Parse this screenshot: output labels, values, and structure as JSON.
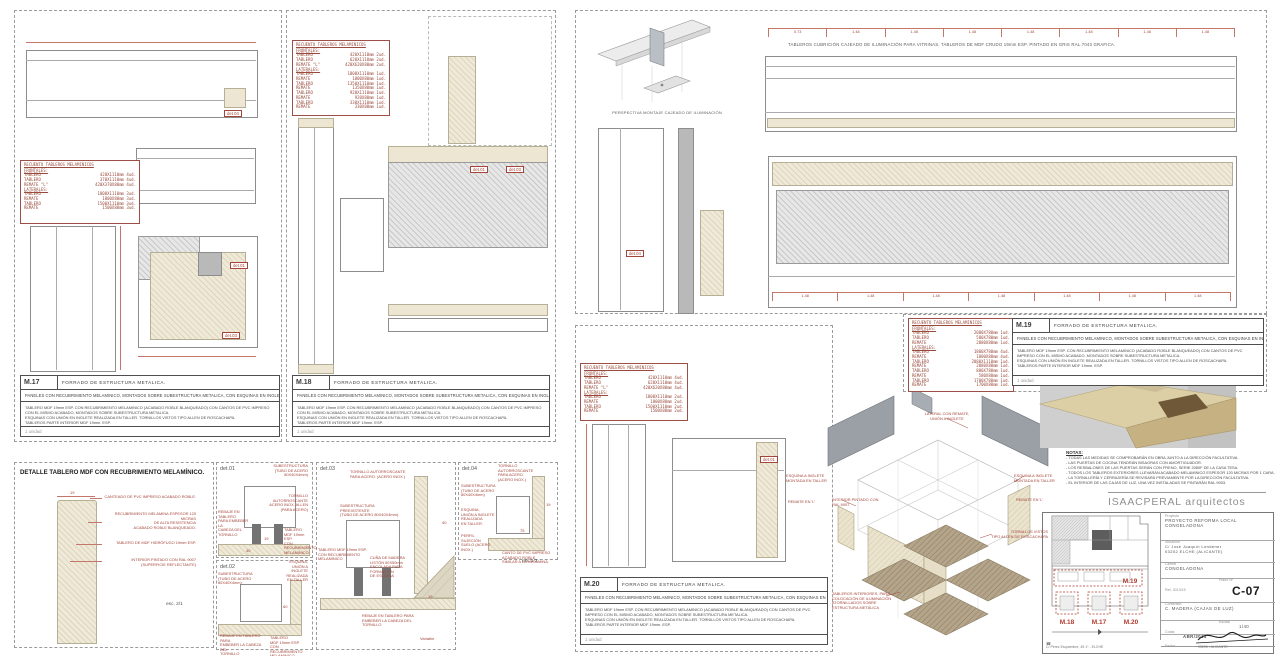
{
  "shared": {
    "recuento_title": "RECUENTO TABLEROS MELAMINICOS",
    "forrado_title": "FORRADO DE ESTRUCTURA METALICA.",
    "paneles_sub": "PANELES CON RECUBRIMIENTO MELAMINICO, MONTADOS SOBRE SUBESTRUCTURA METALICA, CON ESQUINAS EN INGLETE",
    "body_l1": "TABLERO MDF 19mm ESP. CON RECUBRIMIENTO MELAMINICO (ACABADO ROBLE BLANQUEADO) CON CANTOS DE PVC IMPRESO CON EL MISMO ACABADO, MONTADOS SOBRE SUBESTRUCTURA METALICA.",
    "body_l2": "ESQUINAS CON UNIÓN EN INGLETE REALIZADA EN TALLER. TORNILLOS VISTOS TIPO ALLEN DE ROSCACHAPA.",
    "body_l3": "TABLEROS PARTE INTERIOR MDF 19mm. ESP.",
    "units": "1 unidad"
  },
  "m17": {
    "code": "M.17",
    "rows": [
      {
        "a": "FRONTALES:",
        "b": "",
        "h": 1
      },
      {
        "a": "TABLERO",
        "b": "420X1110mm 4ud."
      },
      {
        "a": "TABLERO",
        "b": "370X1110mm 4ud."
      },
      {
        "a": "REMATE \"L\"",
        "b": "420X370X80mm 4ud."
      },
      {
        "a": "LATERALES:",
        "b": "",
        "h": 1
      },
      {
        "a": "TABLERO",
        "b": "1800X1110mm 3ud."
      },
      {
        "a": "REMATE",
        "b": "1800X80mm 3ud."
      },
      {
        "a": "TABLERO",
        "b": "1500X1110mm 3ud."
      },
      {
        "a": "REMATE",
        "b": "1500X80mm 3ud."
      }
    ]
  },
  "m18": {
    "code": "M.18",
    "rows": [
      {
        "a": "FRONTALES:",
        "b": "",
        "h": 1
      },
      {
        "a": "TABLERO",
        "b": "420X1110mm 2ud."
      },
      {
        "a": "TABLERO",
        "b": "620X1110mm 2ud."
      },
      {
        "a": "REMATE \"L\"",
        "b": "420X620X80mm 2ud."
      },
      {
        "a": "LATERALES:",
        "b": "",
        "h": 1
      },
      {
        "a": "TABLERO",
        "b": "1800X1110mm 1ud."
      },
      {
        "a": "REMATE",
        "b": "1800X80mm 1ud."
      },
      {
        "a": "TABLERO",
        "b": "1350X1110mm 1ud."
      },
      {
        "a": "REMATE",
        "b": "1350X80mm 1ud."
      },
      {
        "a": "TABLERO",
        "b": "920X1110mm 1ud."
      },
      {
        "a": "REMATE",
        "b": "920X80mm 1ud."
      },
      {
        "a": "TABLERO",
        "b": "330X1110mm 1ud."
      },
      {
        "a": "REMATE",
        "b": "330X80mm 1ud."
      }
    ]
  },
  "m19": {
    "code": "M.19",
    "rows": [
      {
        "a": "FRONTALES:",
        "b": "",
        "h": 1
      },
      {
        "a": "TABLERO",
        "b": "2080X780mm 1ud."
      },
      {
        "a": "TABLERO",
        "b": "580X780mm 1ud."
      },
      {
        "a": "REMATE",
        "b": "2080X80mm 1ud."
      },
      {
        "a": "LATERALES:",
        "b": "",
        "h": 1
      },
      {
        "a": "TABLERO",
        "b": "1800X780mm 4ud."
      },
      {
        "a": "REMATE",
        "b": "1800X80mm 4ud."
      },
      {
        "a": "TABLERO",
        "b": "2080X1110mm 1ud."
      },
      {
        "a": "REMATE",
        "b": "2080X80mm 1ud."
      },
      {
        "a": "TABLERO",
        "b": "800X780mm 1ud."
      },
      {
        "a": "REMATE",
        "b": "580X80mm 1ud."
      },
      {
        "a": "TABLERO",
        "b": "1700X780mm 1ud."
      },
      {
        "a": "REMATE",
        "b": "1700X80mm 1ud."
      }
    ]
  },
  "m20": {
    "code": "M.20",
    "rows": [
      {
        "a": "FRONTALES:",
        "b": "",
        "h": 1
      },
      {
        "a": "TABLERO",
        "b": "420X1110mm 4ud."
      },
      {
        "a": "TABLERO",
        "b": "620X1110mm 4ud."
      },
      {
        "a": "REMATE \"L\"",
        "b": "420X620X80mm 4ud."
      },
      {
        "a": "LATERALES:",
        "b": "",
        "h": 1
      },
      {
        "a": "TABLERO",
        "b": "1800X1110mm 2ud."
      },
      {
        "a": "REMATE",
        "b": "1800X80mm 2ud."
      },
      {
        "a": "TABLERO",
        "b": "1500X1110mm 2ud."
      },
      {
        "a": "REMATE",
        "b": "1500X80mm 2ud."
      }
    ]
  },
  "top": {
    "caption": "TABLEROS CUBRICIÓN CAJEADO DE ILUMINACIÓN PARA VITRINAS. TABLEROS DE MDF CRUDO 19mm ESP. PINTADO EN GRIS RAL.7043 GRAFICA.",
    "perspective_caption": "PERSPECTIVA MONTAJE CAJEADO DE ILUMINACIÓN",
    "dims_top": [
      "0.73",
      "1.48",
      "1.48",
      "1.48",
      "1.48",
      "1.48",
      "1.48",
      "1.48"
    ],
    "dims_bottom": [
      "1.48",
      "1.48",
      "1.48",
      "1.48",
      "1.48",
      "1.48",
      "1.48"
    ]
  },
  "refs": {
    "d1": "det.01",
    "d2": "det.02",
    "d3": "det.03",
    "d4": "det.04"
  },
  "mdf_detail": {
    "title": "DETALLE TABLERO MDF CON RECUBRIMIENTO MELAMÍNICO.",
    "l1": "CANTEADO DE PVC IMPRESO ACABADO ROBLE.",
    "l2": "RECUBRIMIENTO MELAMINA ESPESOR 120 MICRAS\nDE ALTA RESISTENCIA\nACABADO ROBLE BLANQUEADO.",
    "l3": "TABLERO DE MDF HIDRÓFUGO 19mm ESP.",
    "l4": "INTERIOR PINTADO CON RAL 9007\n(SUPERFICIE REFLECTANTE)",
    "dim19": "19",
    "scale": "esc. 2/1"
  },
  "det01": {
    "name": "det.01",
    "l1": "SUBESTRUCTURA\n(TUBO DE ACERO 80X40X4mm)",
    "l2": "TORNILLO\nAUTORROSCANTE\nACERO INOX. ALLEN\n(PARA ACERO)",
    "l3": "REBAJE EN TABLERO\nPARA EMBEBER LA\nCABEZA DEL\nTORNILLO",
    "l4": "TABLERO\nMDF 19mm ESP.\nCON RECUBRIMIENTO\nMELAMINICO",
    "dim1": "19",
    "dim2": "40"
  },
  "det02": {
    "name": "det.02",
    "l1": "SUBESTRUCTURA\n(TUBO DE ACERO 80X40X4mm)",
    "l2": "ESQUINA,\nUNIÓN A INGLETE\nREALIZADA\nEN TALLER",
    "l3": "REBAJE EN TABLERO PARA\nEMBEBER LA CABEZA DEL\nTORNILLO",
    "l4": "TABLERO\nMDF 19mm ESP.\nCON RECUBRIMIENTO\nMELAMINICO",
    "dim1": "60"
  },
  "det03": {
    "name": "det.03",
    "l1": "TORNILLO AUTORROSCANTE\nPARA ACERO. (ACERO INOX.)",
    "l2": "SUBESTRUCTURA PREEXISTENTE\n(TUBO DE ACERO 80X40X4mm)",
    "l3": "TABLERO MDF 19mm ESP.\nCON RECUBRIMIENTO MELAMINICO",
    "l4": "CUÑA DE MADERA\nLISTÓN 50X50mm\nENCOLADA PARA FORMACIÓN\nDE ESQUINA",
    "l5": "REBAJE EN TABLERO PARA\nEMBEBER LA CABEZA DEL TORNILLO",
    "dim1": "40",
    "dim2": "19",
    "dim3": "Variable"
  },
  "det04": {
    "name": "det.04",
    "l1": "TORNILLO\nAUTORROSCANTE\nPARA ACERO\n(ACERO INOX.)",
    "l2": "SUBESTRUCTURA\n(TUBO DE ACERO\n80X40X4mm)",
    "l3": "ESQUINA,\nUNIÓN A INGLETE\nREALIZADA\nEN TALLER.",
    "l4": "PERFIL SUJECIÓN\nSUELO (ACERO INOX.)",
    "l5": "CANTO DE PVC IMPRESO\nACABADO ROBLE\nSIMILAR A LA MELAMINA.",
    "dim1": "19",
    "dim2": "75",
    "scale": "esc.1/2"
  },
  "panel_d": {
    "esquina": "ESQUINA A INGLETE\nMONTADA EN TALLER",
    "remate": "REMATE EN 'L'"
  },
  "iso": {
    "lateral": "LATERAL CON REMATE,\nUNIÓN A INGLETE",
    "esquina": "ESQUINA A INGLETE\nMONTADA EN TALLER",
    "remate": "REMATE EN 'L'",
    "interior": "INTERIOR PINTADO CON\nRAL.9007",
    "tornillos": "TORNILLOS VISTOS\nTIPO ALLEN DE ROSCACHAPA",
    "tableros": "TABLEROS INTERIORES, PARA\nCOLOCACIÓN DE ILUMINACIÓN\nATORNILLADOS SOBRE\nESTRUCTURA METÁLICA"
  },
  "notas": {
    "title": "NOTAS:",
    "items": [
      "- TODAS LAS MEDIDAS SE COMPROBARÁN EN OBRA JUNTO A LA DIRECCIÓN FACULTATIVA.",
      "- LAS PUERTAS DE COCINA TENDRÁN BISAGRAS CON AMORTIGUADOR.",
      "- LOS RESBALONES DE LAS PUERTAS SERÁN CON FRENO, SERIE 2080F DE LA CASA TESA.",
      "- TODOS LOS TABLEROS EXTERIORES LLEVARÁN ACABADO MELAMINICO ESPESOR 120 MICRAS POR 1 CARA.",
      "- LA TORNILLERÍA Y CERRAJERÍA SE REVISARÁ PREVIAMENTE POR LA DIRECCIÓN FACULTATIVA.",
      "- EL INTERIOR DE LAS CAJAS DE LUZ, UNA VEZ INSTALADAS SE PINTARÁN RAL.9003."
    ]
  },
  "titleblock": {
    "firm": "ISAACPERAL arquitectos",
    "proyecto_label": "Proyecto",
    "proyecto": "PROYECTO REFORMA LOCAL\nCONGELADONA",
    "situacion_label": "Situación",
    "situacion": "C/ José Joaquín Londener\n03202 ELCHE (ALICANTE)",
    "cliente_label": "Cliente",
    "cliente": "CONGELADONA",
    "ref": "Ref. 3013/15",
    "plano_label": "Plano Nº",
    "plano": "C-07",
    "contenido_label": "Contenido",
    "contenido": "C. MADERA (CAJAS DE LUZ)",
    "cotas_label": "Cotas",
    "escala_label": "Escala",
    "escala": "1/40",
    "fecha_label": "Fecha",
    "fecha": "ABR/2014",
    "footer_left": "C/ Pérez Esquembre, 45 1º - ELCHE",
    "footer_right": "03203 - ALICANTE",
    "keyplan": {
      "m19": "M.19",
      "m18": "M.18",
      "m17": "M.17",
      "m20": "M.20"
    }
  }
}
